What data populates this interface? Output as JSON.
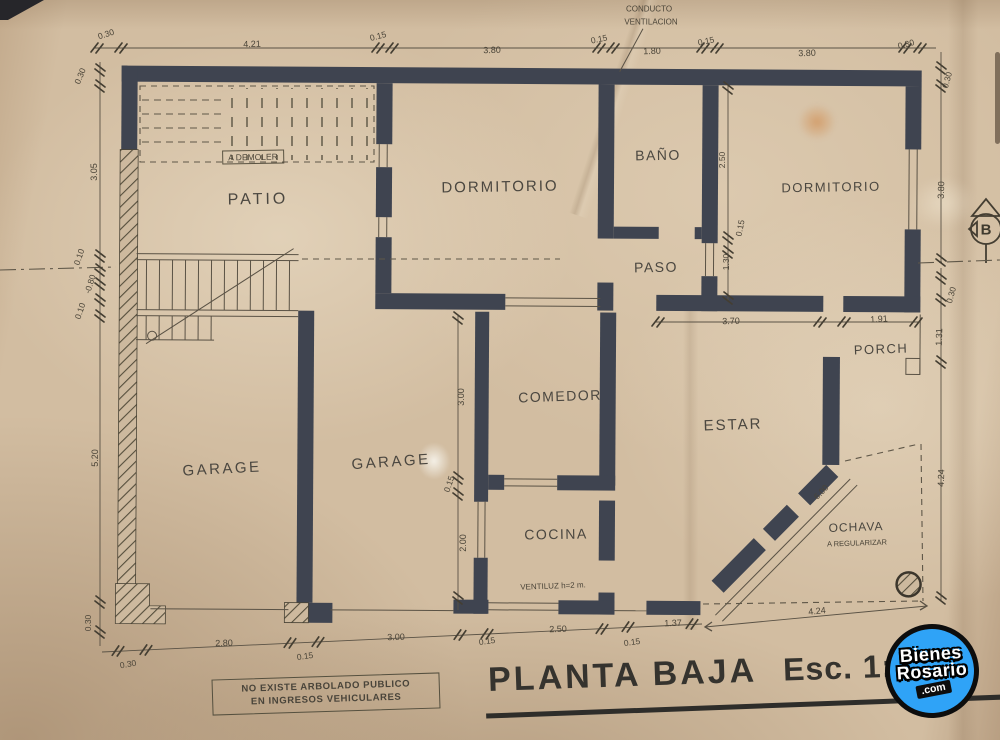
{
  "title": {
    "plan": "PLANTA BAJA",
    "scale": "Esc. 1:"
  },
  "note_box": {
    "line1": "NO EXISTE ARBOLADO PUBLICO",
    "line2": "EN INGRESOS VEHICULARES"
  },
  "watermark": {
    "top": "Bienes",
    "bottom": "Rosario",
    "suffix": ".com",
    "color": "#2fa3f7"
  },
  "colors": {
    "paper": "#d2bda1",
    "wall_ink": "#3f4450",
    "line_ink": "#5a5245",
    "text_ink": "#4a4438"
  },
  "plan": {
    "labels": [
      {
        "name": "room-patio",
        "text": "PATIO",
        "x": 258,
        "y": 200,
        "r": -1,
        "s": 16,
        "cls": "room",
        "ls": 3
      },
      {
        "name": "room-dormitorio-1",
        "text": "DORMITORIO",
        "x": 500,
        "y": 187,
        "r": -1,
        "s": 15,
        "cls": "room",
        "ls": 2
      },
      {
        "name": "room-bano",
        "text": "BAÑO",
        "x": 658,
        "y": 155,
        "r": -1,
        "s": 14,
        "cls": "room",
        "ls": 1.5
      },
      {
        "name": "room-paso",
        "text": "PASO",
        "x": 656,
        "y": 267,
        "r": -1,
        "s": 14,
        "cls": "room",
        "ls": 1.5
      },
      {
        "name": "room-dormitorio-2",
        "text": "DORMITORIO",
        "x": 831,
        "y": 187,
        "r": -1,
        "s": 13,
        "cls": "room",
        "ls": 1.5
      },
      {
        "name": "room-garage-1",
        "text": "GARAGE",
        "x": 222,
        "y": 469,
        "r": -3,
        "s": 15,
        "cls": "room",
        "ls": 2.5
      },
      {
        "name": "room-garage-2",
        "text": "GARAGE",
        "x": 391,
        "y": 462,
        "r": -4,
        "s": 15,
        "cls": "room",
        "ls": 2.5
      },
      {
        "name": "room-comedor",
        "text": "COMEDOR",
        "x": 560,
        "y": 396,
        "r": -2,
        "s": 14,
        "cls": "room",
        "ls": 1.5
      },
      {
        "name": "room-cocina",
        "text": "COCINA",
        "x": 556,
        "y": 534,
        "r": -1,
        "s": 14,
        "cls": "room",
        "ls": 1.5
      },
      {
        "name": "room-estar",
        "text": "ESTAR",
        "x": 733,
        "y": 425,
        "r": -2,
        "s": 15,
        "cls": "room",
        "ls": 2
      },
      {
        "name": "room-porch",
        "text": "PORCH",
        "x": 881,
        "y": 349,
        "r": -2,
        "s": 13,
        "cls": "room",
        "ls": 1.5
      },
      {
        "name": "note-conducto-line1",
        "text": "CONDUCTO",
        "x": 649,
        "y": 9,
        "r": 0,
        "s": 8
      },
      {
        "name": "note-conducto-line2",
        "text": "VENTILACION",
        "x": 651,
        "y": 22,
        "r": 0,
        "s": 8
      },
      {
        "name": "note-a-demoler",
        "text": "A DEMOLER",
        "x": 253,
        "y": 157,
        "r": -1,
        "s": 8.5,
        "cls": "boxed"
      },
      {
        "name": "note-ventiluz",
        "text": "VENTILUZ h=2 m.",
        "x": 553,
        "y": 586,
        "r": -2,
        "s": 8
      },
      {
        "name": "note-ochava",
        "text": "OCHAVA",
        "x": 856,
        "y": 527,
        "r": -2,
        "s": 12,
        "cls": "room",
        "ls": 1
      },
      {
        "name": "note-a-regularizar",
        "text": "A REGULARIZAR",
        "x": 857,
        "y": 543,
        "r": -2,
        "s": 7.5
      },
      {
        "name": "symbol-b-letter",
        "text": "B",
        "x": 986,
        "y": 230,
        "r": 0,
        "s": 15,
        "cls": "bsym"
      },
      {
        "name": "dim-top-1",
        "text": "0.30",
        "x": 106,
        "y": 34,
        "r": -18,
        "s": 8.5
      },
      {
        "name": "dim-top-2",
        "text": "4.21",
        "x": 252,
        "y": 44,
        "r": -2,
        "s": 9
      },
      {
        "name": "dim-top-3",
        "text": "0.15",
        "x": 378,
        "y": 36,
        "r": -15,
        "s": 8.5
      },
      {
        "name": "dim-top-4",
        "text": "3.80",
        "x": 492,
        "y": 50,
        "r": -2,
        "s": 9
      },
      {
        "name": "dim-top-5",
        "text": "0.15",
        "x": 599,
        "y": 39,
        "r": -12,
        "s": 8.5
      },
      {
        "name": "dim-top-6",
        "text": "1.80",
        "x": 652,
        "y": 51,
        "r": -2,
        "s": 9
      },
      {
        "name": "dim-top-7",
        "text": "0.15",
        "x": 706,
        "y": 41,
        "r": -12,
        "s": 8.5
      },
      {
        "name": "dim-top-8",
        "text": "3.80",
        "x": 807,
        "y": 53,
        "r": -2,
        "s": 9
      },
      {
        "name": "dim-top-9",
        "text": "0.30",
        "x": 906,
        "y": 44,
        "r": -15,
        "s": 8.5
      },
      {
        "name": "dim-left-1",
        "text": "0.30",
        "x": 80,
        "y": 76,
        "r": -68,
        "s": 8.5
      },
      {
        "name": "dim-left-2",
        "text": "3.05",
        "x": 94,
        "y": 172,
        "r": -90,
        "s": 9
      },
      {
        "name": "dim-left-3",
        "text": "0.10",
        "x": 79,
        "y": 257,
        "r": -72,
        "s": 8.5
      },
      {
        "name": "dim-left-4",
        "text": "-0.80",
        "x": 90,
        "y": 284,
        "r": -72,
        "s": 8.5
      },
      {
        "name": "dim-left-5",
        "text": "0.10",
        "x": 80,
        "y": 311,
        "r": -72,
        "s": 8.5
      },
      {
        "name": "dim-left-6",
        "text": "5.20",
        "x": 95,
        "y": 458,
        "r": -90,
        "s": 9
      },
      {
        "name": "dim-left-7",
        "text": "0.30",
        "x": 88,
        "y": 623,
        "r": -90,
        "s": 8.5
      },
      {
        "name": "dim-bottom-1",
        "text": "0.30",
        "x": 128,
        "y": 664,
        "r": -10,
        "s": 8.5
      },
      {
        "name": "dim-bottom-2",
        "text": "2.80",
        "x": 224,
        "y": 643,
        "r": -2,
        "s": 9
      },
      {
        "name": "dim-bottom-3",
        "text": "0.15",
        "x": 305,
        "y": 656,
        "r": -8,
        "s": 8.5
      },
      {
        "name": "dim-bottom-4",
        "text": "3.00",
        "x": 396,
        "y": 637,
        "r": -2,
        "s": 9
      },
      {
        "name": "dim-bottom-5",
        "text": "0.15",
        "x": 487,
        "y": 641,
        "r": -8,
        "s": 8.5
      },
      {
        "name": "dim-bottom-6",
        "text": "2.50",
        "x": 558,
        "y": 629,
        "r": -2,
        "s": 9
      },
      {
        "name": "dim-bottom-7",
        "text": "0.15",
        "x": 632,
        "y": 642,
        "r": -8,
        "s": 8.5
      },
      {
        "name": "dim-bottom-8",
        "text": "1.37",
        "x": 673,
        "y": 623,
        "r": -2,
        "s": 9
      },
      {
        "name": "dim-bottom-9",
        "text": "4.24",
        "x": 817,
        "y": 611,
        "r": -6,
        "s": 9
      },
      {
        "name": "dim-right-1",
        "text": "0.30",
        "x": 947,
        "y": 80,
        "r": -75,
        "s": 8.5
      },
      {
        "name": "dim-right-2",
        "text": "3.80",
        "x": 941,
        "y": 190,
        "r": -88,
        "s": 9
      },
      {
        "name": "dim-right-3",
        "text": "0.30",
        "x": 951,
        "y": 295,
        "r": -75,
        "s": 8.5
      },
      {
        "name": "dim-right-4",
        "text": "1.31",
        "x": 939,
        "y": 337,
        "r": -88,
        "s": 9
      },
      {
        "name": "dim-right-5",
        "text": "4.24",
        "x": 941,
        "y": 478,
        "r": -88,
        "s": 9
      },
      {
        "name": "dim-int-1",
        "text": "2.50",
        "x": 722,
        "y": 160,
        "r": -90,
        "s": 8.5
      },
      {
        "name": "dim-int-2",
        "text": "0.15",
        "x": 740,
        "y": 228,
        "r": -78,
        "s": 8.5
      },
      {
        "name": "dim-int-3",
        "text": "1.30",
        "x": 726,
        "y": 262,
        "r": -90,
        "s": 8.5
      },
      {
        "name": "dim-int-4",
        "text": "3.70",
        "x": 731,
        "y": 321,
        "r": -2,
        "s": 9
      },
      {
        "name": "dim-int-5",
        "text": "1.91",
        "x": 879,
        "y": 319,
        "r": -3,
        "s": 9
      },
      {
        "name": "dim-int-6",
        "text": "3.00",
        "x": 461,
        "y": 397,
        "r": -90,
        "s": 9
      },
      {
        "name": "dim-int-7",
        "text": "0.15",
        "x": 449,
        "y": 484,
        "r": -72,
        "s": 8.5
      },
      {
        "name": "dim-int-8",
        "text": "2.00",
        "x": 463,
        "y": 543,
        "r": -90,
        "s": 9
      },
      {
        "name": "dim-int-9",
        "text": "6.00",
        "x": 821,
        "y": 492,
        "r": -46,
        "s": 8.5
      }
    ]
  }
}
